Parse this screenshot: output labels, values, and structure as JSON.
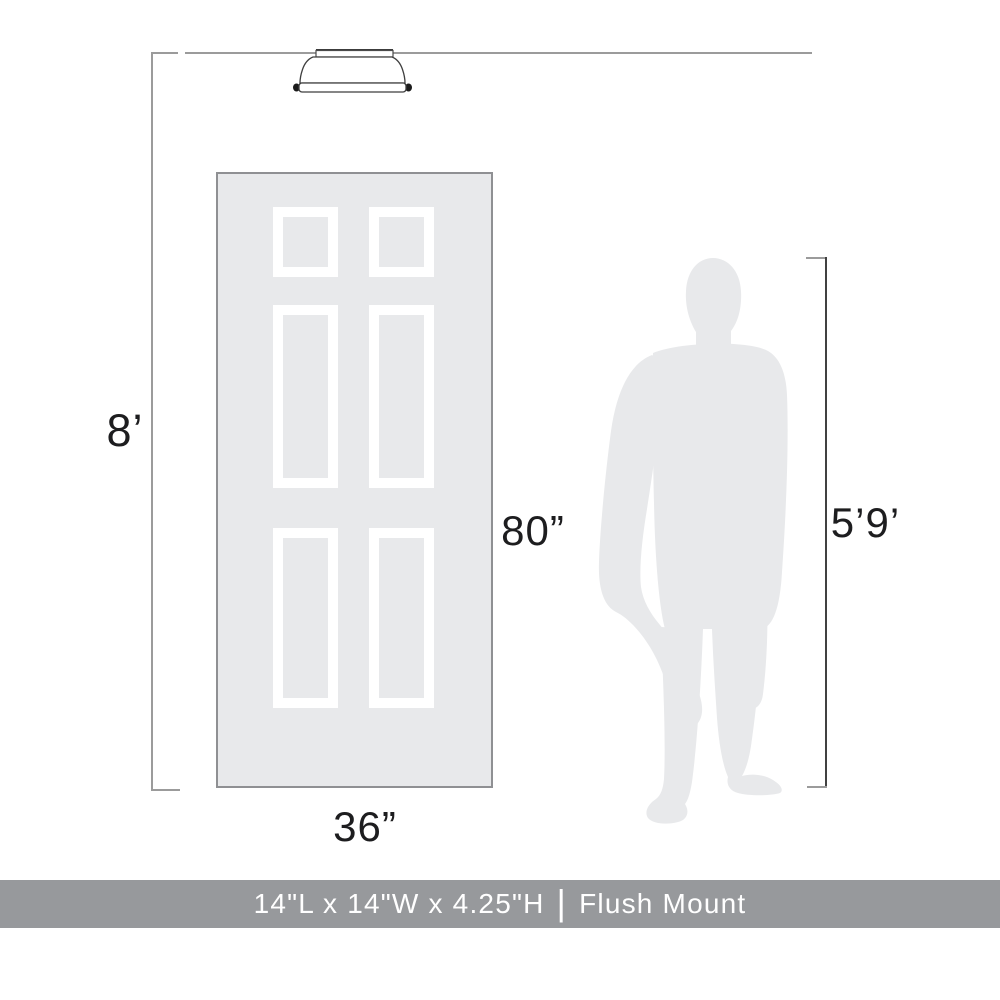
{
  "page": {
    "background": "#ffffff",
    "type": "product-scale-diagram"
  },
  "measurements": {
    "ceiling_height": {
      "label": "8’"
    },
    "door_height": {
      "label": "80”"
    },
    "door_width": {
      "label": "36”"
    },
    "person_height": {
      "label": "5’9’"
    }
  },
  "illustrations": {
    "fixture": "flush-mount-ceiling-light",
    "door": "six-panel-door",
    "person": "standing-man-silhouette"
  },
  "footer": {
    "dimensions": "14\"L x 14\"W x 4.25\"H",
    "separator": "|",
    "product_type": "Flush Mount",
    "background": "#97999c",
    "text_color": "#ffffff"
  },
  "colors": {
    "silhouette_fill": "#e8e9eb",
    "door_fill": "#e8e9eb",
    "door_border": "#8f9093",
    "panel_border": "#ffffff",
    "line_gray": "#9b9b9b",
    "line_dark": "#414141",
    "label_text": "#1d1d1f"
  }
}
